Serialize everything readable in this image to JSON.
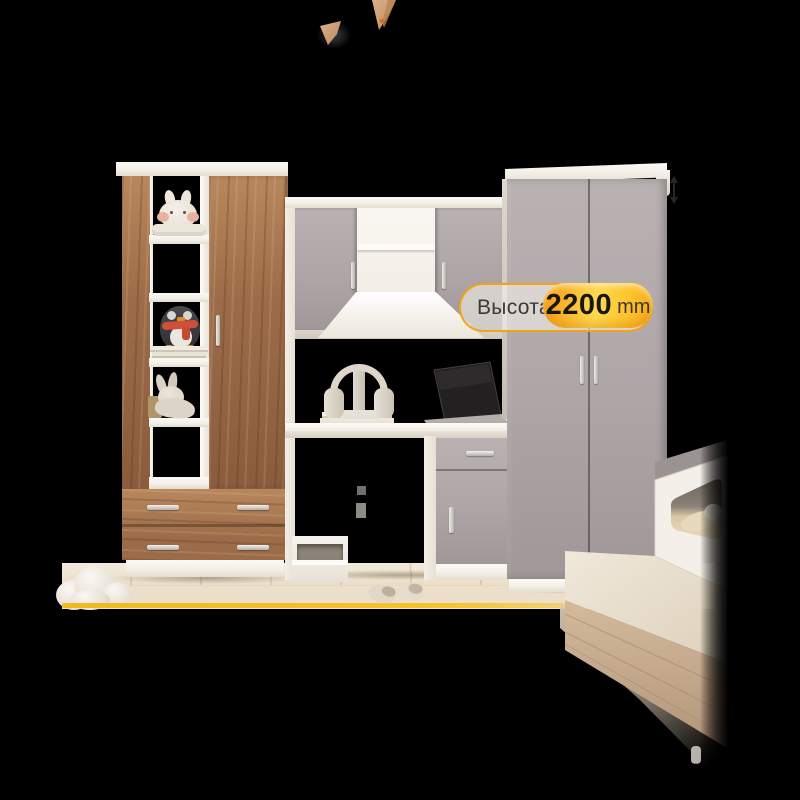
{
  "badge": {
    "label": "Высота",
    "value": "2200",
    "unit": "mm"
  },
  "colors": {
    "bg": "#000000",
    "white_furn": "#f2eee7",
    "white_bright": "#fcfaf6",
    "white_shade": "#d9d2c6",
    "gray_door": "#ada5a6",
    "gray_door_light": "#b9b1b2",
    "gray_door_dark": "#8d8586",
    "walnut": "#9c6c48",
    "walnut_dark": "#76503a",
    "walnut_light": "#b8875c",
    "ash": "#c9ad90",
    "ash_dark": "#ae9175",
    "bed_top": "#e9e0d1",
    "floor_light": "#f2eadb",
    "floor_dark": "#e6d7c0",
    "rug": "#ece1cd",
    "yellow_line": "#f6c32a",
    "badge_border": "#f4a315",
    "badge_fill": "rgba(252,248,240,0.55)",
    "pill_orange": "#f8990f",
    "pill_yellow": "#ffd950",
    "badge_label_color": "#3b3935",
    "badge_value_color": "#191712",
    "badge_unit_color": "#3a372f",
    "handle_metal": "#cbc7c2"
  }
}
